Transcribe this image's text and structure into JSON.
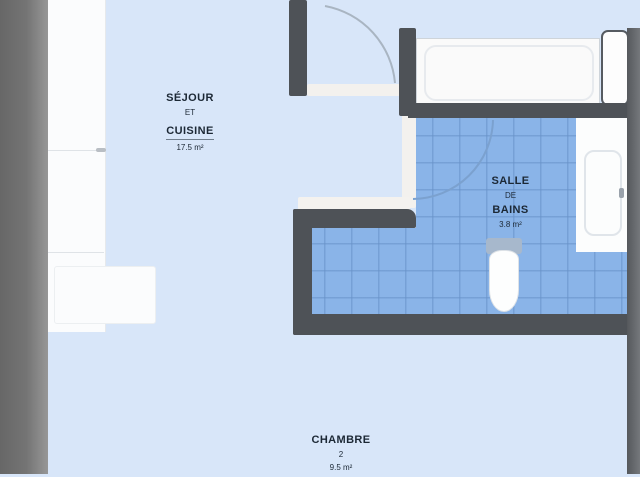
{
  "plan": {
    "rooms": {
      "living": {
        "name": "SÉJOUR",
        "conj": "ET",
        "name2": "CUISINE",
        "area": "17.5 m²"
      },
      "bathroom": {
        "name": "SALLE",
        "conj": "DE",
        "name2": "BAINS",
        "area": "3.8 m²"
      },
      "bedroom": {
        "name": "CHAMBRE",
        "number": "2",
        "area": "9.5 m²"
      }
    },
    "fixtures": {
      "kitchen_counter": "kitchen counter",
      "counter_return": "counter return",
      "bathtub": "bathtub",
      "vanity_sink": "vanity sink",
      "toilet": "toilet",
      "door_leaf": "door leaf",
      "entry_door_swing": "entry door swing",
      "bathroom_door_swing": "bathroom door swing"
    },
    "colors": {
      "floor": "#d8e6f9",
      "tile": "#8ab4e8",
      "tile_grid": "#6791c6",
      "wall_interior": "#4e5257",
      "wall_exterior": "#6a6a6a",
      "fixture_white": "#fbfcfd",
      "label_text": "#1c2835",
      "arc_light": "#a9b5c2",
      "arc_blue": "#7ba1cf"
    }
  }
}
